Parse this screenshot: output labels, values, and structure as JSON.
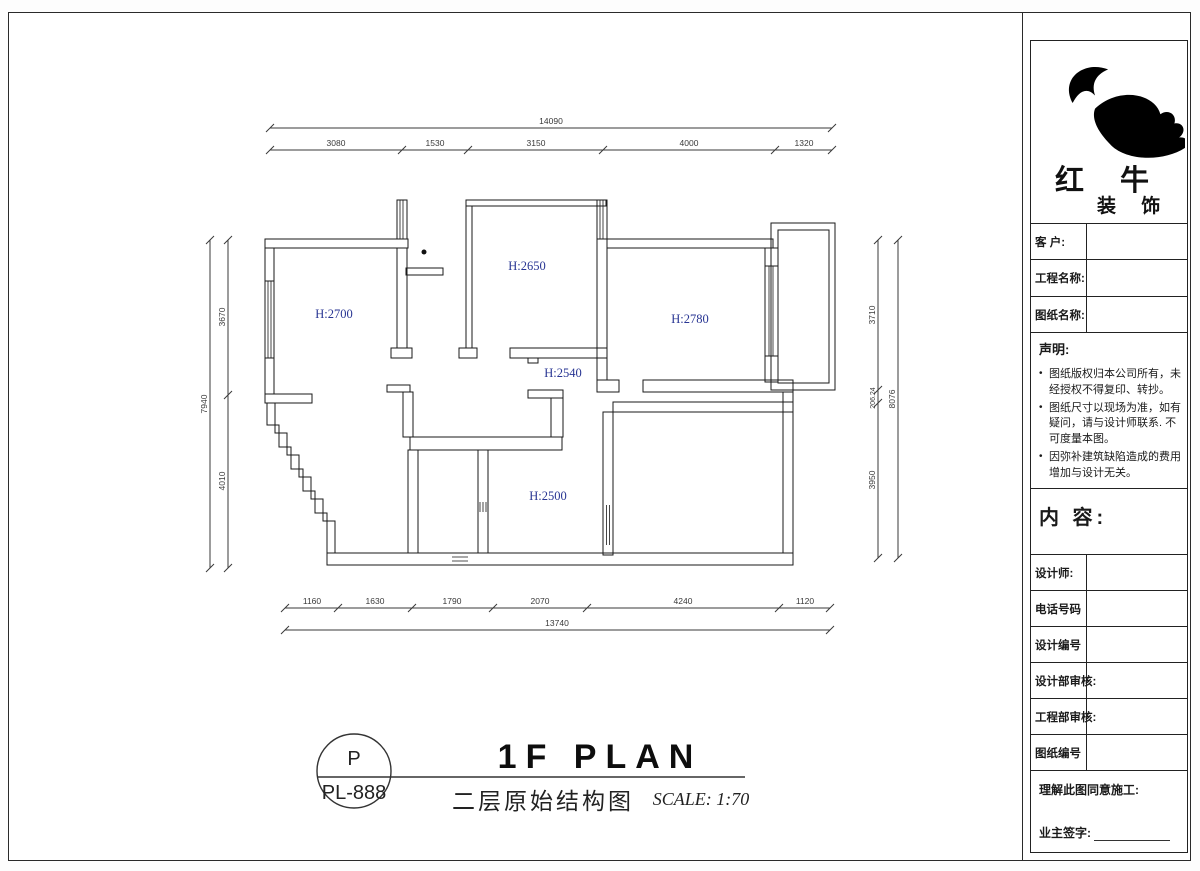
{
  "colors": {
    "line": "#1a1a1a",
    "room_label": "#283593",
    "dim_text": "#3a3a3a",
    "logo": "#000000"
  },
  "plan": {
    "rooms": [
      {
        "label": "H:2700"
      },
      {
        "label": "H:2650"
      },
      {
        "label": "H:2780"
      },
      {
        "label": "H:2540"
      },
      {
        "label": "H:2500"
      }
    ],
    "dims": {
      "top_overall": "14090",
      "top_segments": [
        "3080",
        "1530",
        "3150",
        "4000",
        "1320"
      ],
      "bottom_segments": [
        "1160",
        "1630",
        "1790",
        "2070",
        "4240",
        "1120"
      ],
      "bottom_overall": "13740",
      "left_segments": [
        "3670",
        "4010"
      ],
      "left_overall": "7940",
      "right_segments": [
        "3710",
        "206.24",
        "3950"
      ],
      "right_overall": "8076"
    }
  },
  "titlebar": {
    "tag_top": "P",
    "tag_bottom": "PL-888",
    "title_en": "1F PLAN",
    "title_cn": "二层原始结构图",
    "scale": "SCALE: 1:70"
  },
  "sidebar": {
    "brand": {
      "line1": "红 牛",
      "line2": "装 饰"
    },
    "fields": [
      {
        "label": "客  户:"
      },
      {
        "label": "工程名称:"
      },
      {
        "label": "图纸名称:"
      }
    ],
    "statement": {
      "heading": "声明:",
      "items": [
        "图纸版权归本公司所有，未经授权不得复印、转抄。",
        "图纸尺寸以现场为准，如有疑问，请与设计师联系. 不可度量本图。",
        "因弥补建筑缺陷造成的费用增加与设计无关。"
      ]
    },
    "content_heading": "内 容:",
    "rows": [
      {
        "label": "设计师:"
      },
      {
        "label": "电话号码"
      },
      {
        "label": "设计编号"
      },
      {
        "label": "设计部审核:"
      },
      {
        "label": "工程部审核:"
      },
      {
        "label": "图纸编号"
      }
    ],
    "approval": {
      "line1": "理解此图同意施工:",
      "line2": "业主签字:"
    }
  }
}
